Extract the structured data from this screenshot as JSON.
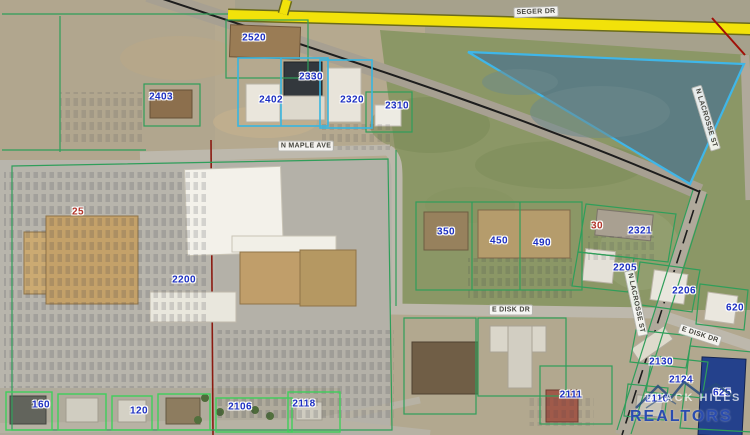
{
  "map": {
    "parcel_labels": [
      {
        "value": "2520",
        "x": 254,
        "y": 38,
        "color": "blue"
      },
      {
        "value": "2403",
        "x": 161,
        "y": 97,
        "color": "blue"
      },
      {
        "value": "2330",
        "x": 311,
        "y": 77,
        "color": "blue"
      },
      {
        "value": "2402",
        "x": 271,
        "y": 100,
        "color": "blue"
      },
      {
        "value": "2320",
        "x": 352,
        "y": 100,
        "color": "blue"
      },
      {
        "value": "2310",
        "x": 397,
        "y": 106,
        "color": "blue"
      },
      {
        "value": "25",
        "x": 78,
        "y": 212,
        "color": "red"
      },
      {
        "value": "2200",
        "x": 184,
        "y": 280,
        "color": "blue"
      },
      {
        "value": "350",
        "x": 446,
        "y": 232,
        "color": "blue"
      },
      {
        "value": "450",
        "x": 499,
        "y": 241,
        "color": "blue"
      },
      {
        "value": "490",
        "x": 542,
        "y": 243,
        "color": "blue"
      },
      {
        "value": "30",
        "x": 597,
        "y": 226,
        "color": "red"
      },
      {
        "value": "2321",
        "x": 640,
        "y": 231,
        "color": "blue"
      },
      {
        "value": "2205",
        "x": 625,
        "y": 268,
        "color": "blue"
      },
      {
        "value": "2206",
        "x": 684,
        "y": 291,
        "color": "blue"
      },
      {
        "value": "620",
        "x": 735,
        "y": 308,
        "color": "blue"
      },
      {
        "value": "2130",
        "x": 661,
        "y": 362,
        "color": "blue"
      },
      {
        "value": "2124",
        "x": 681,
        "y": 380,
        "color": "blue"
      },
      {
        "value": "625",
        "x": 722,
        "y": 393,
        "color": "blue"
      },
      {
        "value": "2110",
        "x": 657,
        "y": 399,
        "color": "blue"
      },
      {
        "value": "2111",
        "x": 571,
        "y": 395,
        "color": "blue"
      },
      {
        "value": "2118",
        "x": 304,
        "y": 404,
        "color": "blue"
      },
      {
        "value": "2106",
        "x": 240,
        "y": 407,
        "color": "blue"
      },
      {
        "value": "160",
        "x": 41,
        "y": 405,
        "color": "blue"
      },
      {
        "value": "120",
        "x": 139,
        "y": 411,
        "color": "blue"
      }
    ],
    "street_labels": [
      {
        "name": "SEGER DR",
        "x": 536,
        "y": 12,
        "rot": -2
      },
      {
        "name": "N MAPLE AVE",
        "x": 306,
        "y": 146,
        "rot": 0
      },
      {
        "name": "E DISK DR",
        "x": 511,
        "y": 310,
        "rot": 0
      },
      {
        "name": "E DISK DR",
        "x": 700,
        "y": 335,
        "rot": 18
      },
      {
        "name": "N LACROSSE ST",
        "x": 706,
        "y": 118,
        "rot": 73
      },
      {
        "name": "N LACROSSE ST",
        "x": 636,
        "y": 303,
        "rot": 78
      }
    ],
    "logo": {
      "brand_top": "BLACK HILLS",
      "brand_bottom": "REALTORS"
    },
    "colors": {
      "parcel_label_blue": "#1c2fc2",
      "parcel_label_red": "#b23529",
      "boundary_green": "#2f9e5a",
      "boundary_bright_green": "#3fcf5a",
      "highlight_cyan": "#3fb6e8",
      "road_highlight_yellow": "#f2e20a",
      "section_line_red": "#8b1a10",
      "pond_fill": "#5d7d82",
      "logo_blue": "#2a4cb0"
    }
  }
}
